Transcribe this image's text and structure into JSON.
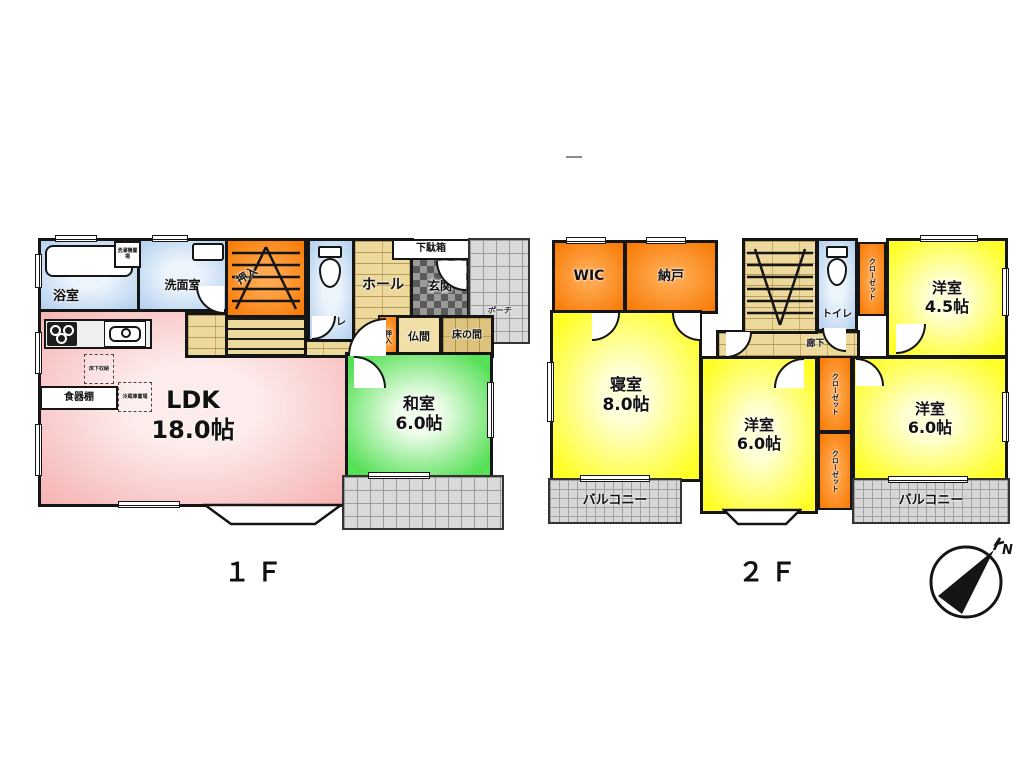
{
  "page": {
    "floor1_label": "１Ｆ",
    "floor2_label": "２Ｆ",
    "compass_north": "N"
  },
  "colors": {
    "ldk_pink": "#f6b2b2",
    "washitsu_green": "#55e055",
    "room_yellow": "#ffff27",
    "storage_orange": "#f87d08",
    "wet_blue": "#b2cfee",
    "wood_floor": "#ecd99b",
    "tile_gray": "#d9d9d9",
    "wall_black": "#151515"
  },
  "floor1": {
    "bath": {
      "name": "浴室"
    },
    "laundry": {
      "name": "洗濯機置場"
    },
    "washroom": {
      "name": "洗面室"
    },
    "stair_closet": {
      "name": "押入"
    },
    "toilet": {
      "name": "トイレ"
    },
    "hall": {
      "name": "ホール"
    },
    "shoe_cabinet": {
      "name": "下駄箱"
    },
    "entrance": {
      "name": "玄関"
    },
    "porch": {
      "name": "ポーチ"
    },
    "oshiire": {
      "name": "押入"
    },
    "butsuma": {
      "name": "仏間"
    },
    "tokonoma": {
      "name": "床の間"
    },
    "washitsu": {
      "name": "和室",
      "size": "6.0帖"
    },
    "ldk": {
      "name": "LDK",
      "size": "18.0帖"
    },
    "cupboard": {
      "name": "食器棚"
    },
    "underfloor_storage": {
      "name": "床下収納"
    },
    "fridge_space": {
      "name": "冷蔵庫置場"
    }
  },
  "floor2": {
    "wic": {
      "name": "WIC"
    },
    "storeroom": {
      "name": "納戸"
    },
    "toilet": {
      "name": "トイレ"
    },
    "closet_top": {
      "name": "クローゼット"
    },
    "closet_mid": {
      "name": "クローゼット"
    },
    "closet_bottom": {
      "name": "クローゼット"
    },
    "corridor": {
      "name": "廊下"
    },
    "bedroom": {
      "name": "寝室",
      "size": "8.0帖"
    },
    "west_room_small": {
      "name": "洋室",
      "size": "4.5帖"
    },
    "west_room_mid": {
      "name": "洋室",
      "size": "6.0帖"
    },
    "west_room_right": {
      "name": "洋室",
      "size": "6.0帖"
    },
    "balcony_left": {
      "name": "バルコニー"
    },
    "balcony_right": {
      "name": "バルコニー"
    }
  }
}
